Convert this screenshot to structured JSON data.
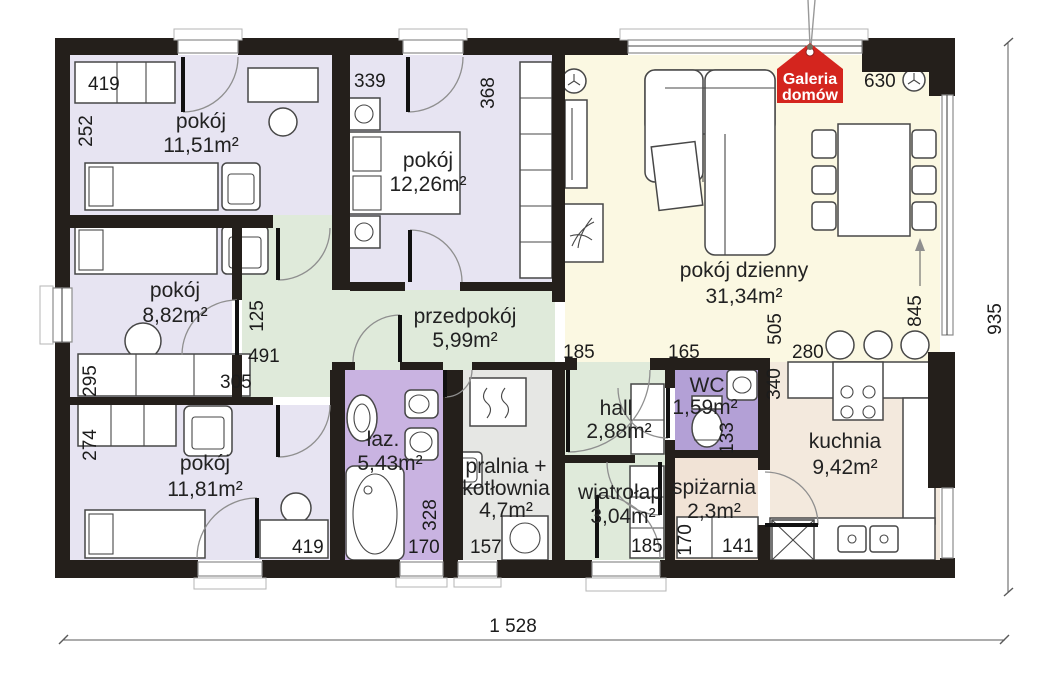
{
  "logo": {
    "line1": "Galeria",
    "line2": "domów"
  },
  "palette": {
    "wall": "#241f1b",
    "lavender": "#e7e4f2",
    "cream": "#fbf8e2",
    "green": "#dfeada",
    "bath_purple": "#c9b3e1",
    "wc_purple": "#b3a0d6",
    "laundry_gray": "#e6e7e4",
    "kitchen_tan": "#f3e9dd",
    "pantry_tan": "#f1e3d6",
    "logo_red": "#d4251e"
  },
  "rooms": {
    "room1": {
      "name": "pokój",
      "area": "11,51m²"
    },
    "room2": {
      "name": "pokój",
      "area": "12,26m²"
    },
    "living": {
      "name": "pokój dzienny",
      "area": "31,34m²"
    },
    "room3": {
      "name": "pokój",
      "area": "8,82m²"
    },
    "hallway": {
      "name": "przedpokój",
      "area": "5,99m²"
    },
    "room4": {
      "name": "pokój",
      "area": "11,81m²"
    },
    "bathroom": {
      "name": "łaz.",
      "area": "5,43m²"
    },
    "laundry": {
      "name_line1": "pralnia +",
      "name_line2": "kotłownia",
      "area": "4,7m²"
    },
    "hall": {
      "name": "hall",
      "area": "2,88m²"
    },
    "wc": {
      "name": "WC",
      "area": "1,59m²"
    },
    "vestibule": {
      "name": "wiatrołap",
      "area": "3,04m²"
    },
    "pantry": {
      "name": "spiżarnia",
      "area": "2,3m²"
    },
    "kitchen": {
      "name": "kuchnia",
      "area": "9,42m²"
    }
  },
  "dims": {
    "r1_width": "419",
    "r1_height": "252",
    "r2_width": "339",
    "r2_wardrobe": "368",
    "living_top": "630",
    "passage_width": "125",
    "hallway_length": "491",
    "r3_sofa": "305",
    "r3_height": "295",
    "r4_height": "274",
    "r4_desk": "419",
    "bath_width": "170",
    "bath_height": "328",
    "laundry_width": "157",
    "hall_width": "185",
    "wc_width": "165",
    "living_height": "505",
    "kitchen_open": "280",
    "glazing": "845",
    "kitchen_depth": "340",
    "wc_height": "133",
    "pantry_shelf_h": "170",
    "pantry_shelf_w": "141",
    "vestibule_wardrobe": "185",
    "total_width": "1 528",
    "total_height": "935"
  }
}
